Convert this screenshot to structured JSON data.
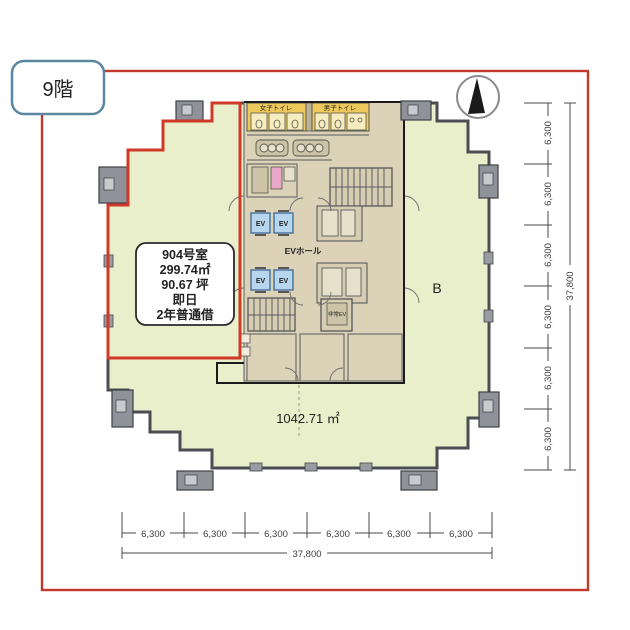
{
  "page": {
    "floor_label": "9階",
    "border_color": "#c0392b"
  },
  "room": {
    "name": "904号室",
    "area_sqm": "299.74㎡",
    "area_tsubo": "90.67 坪",
    "availability": "即日",
    "lease_type": "2年普通借",
    "outline_color": "#cf3a28"
  },
  "plan": {
    "other_area_label": "1042.71 ㎡",
    "section_label": "B",
    "womens_toilet_label": "女子トイレ",
    "mens_toilet_label": "男子トイレ",
    "ev_hall_label": "EVホール",
    "ev_label": "EV",
    "emergency_ev_label": "非常EV",
    "floor_fill": "#e9efca",
    "core_fill": "#dbd2b8",
    "toilet_fill": "#efc95c",
    "ev_fill": "#b7d6ee"
  },
  "icons": {
    "compass": "north-arrow"
  },
  "dimensions": {
    "bottom": {
      "segments": [
        "6,300",
        "6,300",
        "6,300",
        "6,300",
        "6,300",
        "6,300"
      ],
      "total": "37,800"
    },
    "right": {
      "segments": [
        "6,300",
        "6,300",
        "6,300",
        "6,300",
        "6,300",
        "6,300"
      ],
      "total": "37,800"
    }
  }
}
